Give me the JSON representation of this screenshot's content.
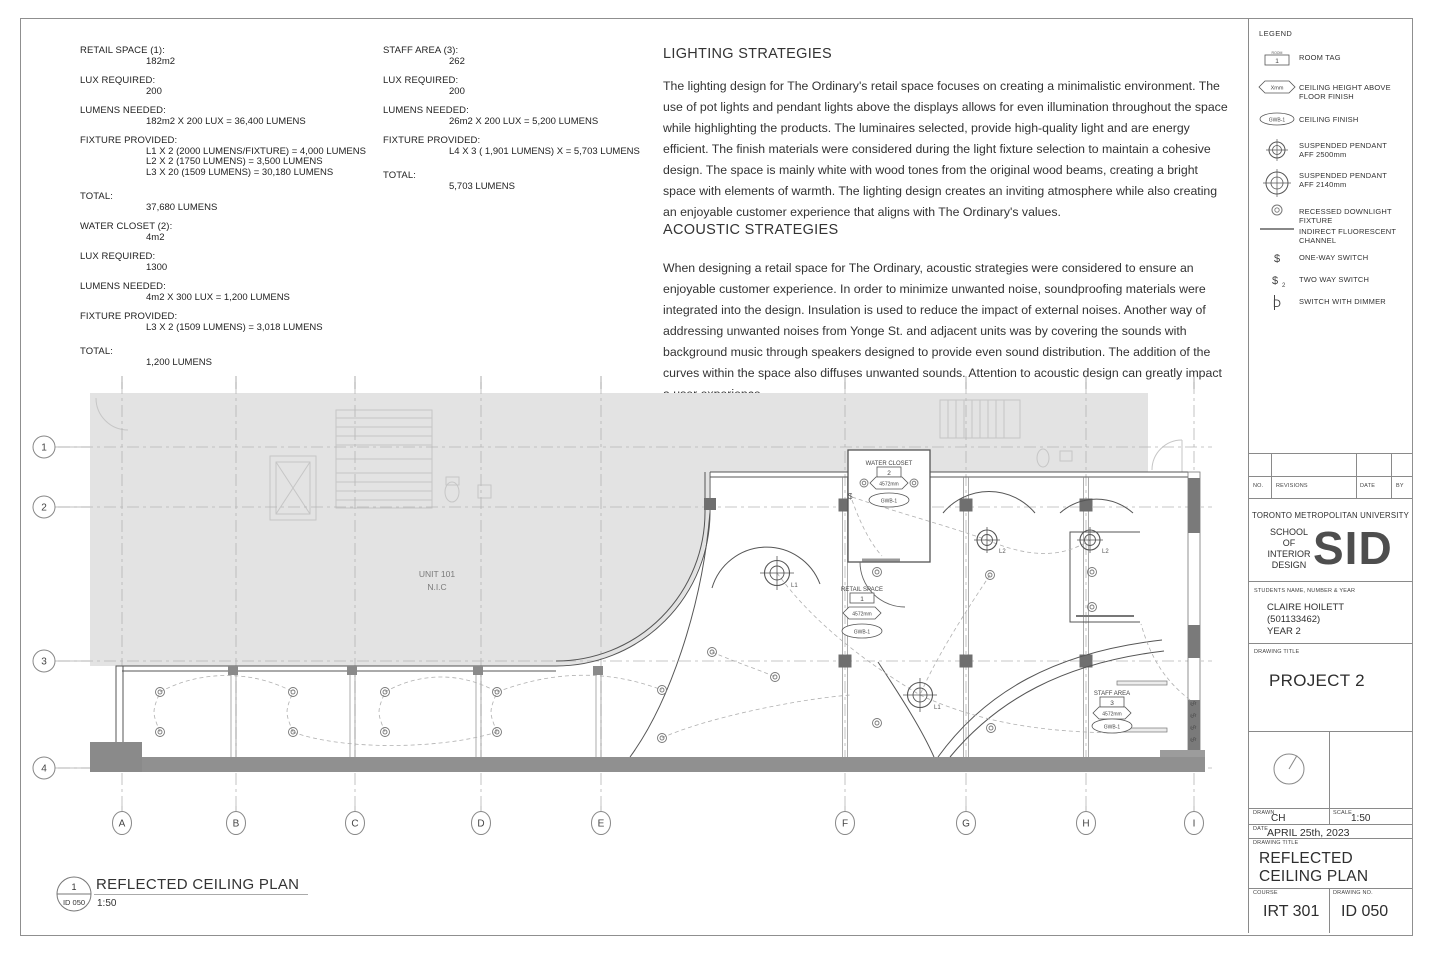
{
  "calcs": {
    "retail": {
      "rows": [
        {
          "label": "RETAIL SPACE (1):",
          "lines": [
            "182m2"
          ]
        },
        {
          "label": "LUX REQUIRED:",
          "lines": [
            "200"
          ]
        },
        {
          "label": "LUMENS NEEDED:",
          "lines": [
            "182m2 X 200 LUX = 36,400 LUMENS"
          ]
        },
        {
          "label": "FIXTURE PROVIDED:",
          "lines": [
            "L1 X 2 (2000 LUMENS/FIXTURE) = 4,000 LUMENS",
            "L2 X 2 (1750 LUMENS)  = 3,500 LUMENS",
            "L3 X 20 (1509 LUMENS) = 30,180 LUMENS"
          ]
        },
        {
          "label": "TOTAL:",
          "lines": [
            "37,680 LUMENS"
          ]
        }
      ]
    },
    "water_closet": {
      "rows": [
        {
          "label": "WATER CLOSET (2):",
          "lines": [
            "4m2"
          ]
        },
        {
          "label": "LUX REQUIRED:",
          "lines": [
            "1300"
          ]
        },
        {
          "label": "LUMENS NEEDED:",
          "lines": [
            "4m2 X 300 LUX = 1,200 LUMENS"
          ]
        },
        {
          "label": "FIXTURE PROVIDED:",
          "lines": [
            "L3 X 2 (1509 LUMENS) = 3,018 LUMENS"
          ]
        },
        {
          "label": "TOTAL:",
          "lines": [
            "1,200 LUMENS"
          ]
        }
      ]
    },
    "staff": {
      "rows": [
        {
          "label": "STAFF AREA (3):",
          "lines": [
            "262"
          ]
        },
        {
          "label": "LUX REQUIRED:",
          "lines": [
            "200"
          ]
        },
        {
          "label": "LUMENS NEEDED:",
          "lines": [
            "26m2 X 200 LUX = 5,200 LUMENS"
          ]
        },
        {
          "label": "FIXTURE PROVIDED:",
          "lines": [
            "L4 X 3 ( 1,901 LUMENS) X = 5,703 LUMENS"
          ]
        },
        {
          "label": "TOTAL:",
          "lines": [
            "5,703 LUMENS"
          ]
        }
      ]
    }
  },
  "strategies": {
    "lighting_title": "LIGHTING STRATEGIES",
    "lighting_body": "The lighting design for The Ordinary's retail space focuses on creating a minimalistic environment. The use of pot lights and pendant lights above the displays allows for even illumination throughout the space while highlighting the products. The luminaires selected, provide high-quality light and are energy efficient. The finish materials were considered during the light fixture selection to maintain a cohesive design. The space is mainly white with wood tones from the original wood beams, creating a  bright space with elements of warmth. The lighting design creates an inviting atmosphere while also creating an enjoyable customer experience that aligns with The Ordinary's values.",
    "acoustic_title": "ACOUSTIC STRATEGIES",
    "acoustic_body": "When designing a retail space for The Ordinary, acoustic strategies were considered to ensure an enjoyable customer experience. In order to minimize unwanted noise, soundproofing materials were integrated into the design. Insulation is used to reduce the impact of external noises. Another way of addressing unwanted noises from Yonge St. and adjacent units was by covering the sounds with background music through speakers designed to provide even sound distribution. The addition of the curves within the space also diffuses unwanted sounds. Attention to acoustic design can greatly impact a user experience."
  },
  "legend": {
    "title": "LEGEND",
    "room_mini": "ROOM",
    "room_num": "1",
    "height_text": "Xmm",
    "finish_text": "GWB-1",
    "switch_glyph": "$",
    "switch2_sub": "2",
    "dimmer_glyph": "D",
    "items": [
      {
        "label": "ROOM TAG"
      },
      {
        "label": "CEILING HEIGHT ABOVE\nFLOOR FINISH"
      },
      {
        "label": "CEILING FINISH"
      },
      {
        "label": "SUSPENDED PENDANT\nAFF 2500mm"
      },
      {
        "label": "SUSPENDED PENDANT\nAFF 2140mm"
      },
      {
        "label": "RECESSED DOWNLIGHT FIXTURE"
      },
      {
        "label": "INDIRECT FLUORESCENT\nCHANNEL"
      },
      {
        "label": "ONE-WAY SWITCH"
      },
      {
        "label": "TWO WAY SWITCH"
      },
      {
        "label": "SWITCH WITH DIMMER"
      }
    ]
  },
  "plan": {
    "grid_cols": [
      "A",
      "B",
      "C",
      "D",
      "E",
      "F",
      "G",
      "H",
      "I"
    ],
    "grid_rows": [
      "1",
      "2",
      "3",
      "4"
    ],
    "unit_line1": "UNIT 101",
    "unit_line2": "N.I.C",
    "labels": {
      "l1": "L1",
      "l2": "L2",
      "switch": "$"
    },
    "tags": {
      "wc": {
        "name": "WATER CLOSET",
        "num": "2",
        "height": "4572mm",
        "finish": "GWB-1"
      },
      "retail": {
        "name": "RETAIL SPACE",
        "num": "1",
        "height": "4572mm",
        "finish": "GWB-1"
      },
      "staff": {
        "name": "STAFF AREA",
        "num": "3",
        "height": "4572mm",
        "finish": "GWB-1"
      }
    }
  },
  "view_title": {
    "number": "1",
    "sheet_ref": "ID 050",
    "title": "REFLECTED CEILING PLAN",
    "scale": "1:50"
  },
  "title_block": {
    "rev_no": "NO.",
    "rev_revisions": "REVISIONS",
    "rev_date": "DATE",
    "rev_by": "BY",
    "university": "TORONTO METROPOLITAN UNIVERSITY",
    "school_lines": [
      "SCHOOL",
      "OF",
      "INTERIOR",
      "DESIGN"
    ],
    "logo": "SID",
    "students_label": "STUDENTS NAME, NUMBER & YEAR",
    "student_name": "CLAIRE HOILETT",
    "student_number": "(501133462)",
    "student_year": "YEAR 2",
    "drawing_title_label": "DRAWING TITLE",
    "project": "PROJECT 2",
    "drawn_label": "DRAWN",
    "drawn": "CH",
    "scale_label": "SCALE",
    "scale": "1:50",
    "date_label": "DATE",
    "date": "APRIL 25th, 2023",
    "drawing_title": "REFLECTED CEILING PLAN",
    "course_label": "COURSE",
    "course": "IRT 301",
    "dwg_no_label": "DRAWING NO.",
    "dwg_no": "ID 050"
  }
}
